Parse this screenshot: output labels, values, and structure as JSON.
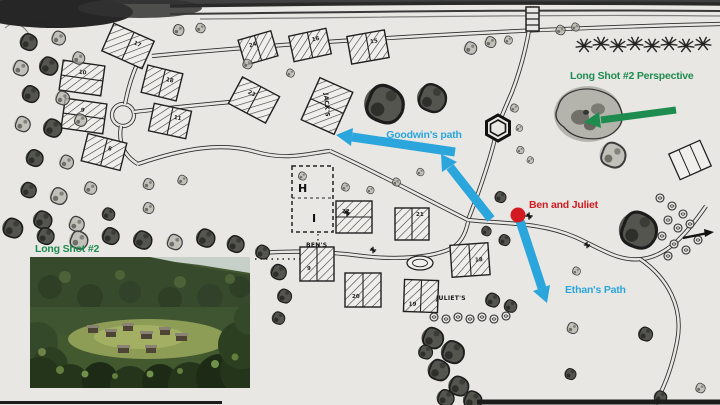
{
  "colors": {
    "annotation_green": "#1e8c4f",
    "annotation_blue": "#2ba6dd",
    "annotation_red": "#d21a21",
    "map_ink": "#232323",
    "paper": "#e8e7e3"
  },
  "annotations": {
    "long_shot_perspective_label": "Long Shot #2 Perspective",
    "goodwins_path_label": "Goodwin's path",
    "ben_and_juliet_label": "Ben and Juliet",
    "ethans_path_label": "Ethan's Path",
    "long_shot_label": "Long Shot #2"
  },
  "map": {
    "labels": {
      "jacks_house": "JACK'S",
      "bens_house": "BEN'S",
      "juliets_house": "JULIET'S"
    },
    "house_numbers": [
      "17",
      "10",
      "18",
      "9",
      "11",
      "8",
      "24",
      "16",
      "15",
      "23",
      "22",
      "21",
      "9",
      "20",
      "19",
      "18"
    ],
    "compound_marks": {
      "top": "H",
      "bottom": "I"
    }
  },
  "inset_photo": {
    "label": "Long Shot #2",
    "description": "long shot of the barracks clearing in a jungle valley"
  }
}
